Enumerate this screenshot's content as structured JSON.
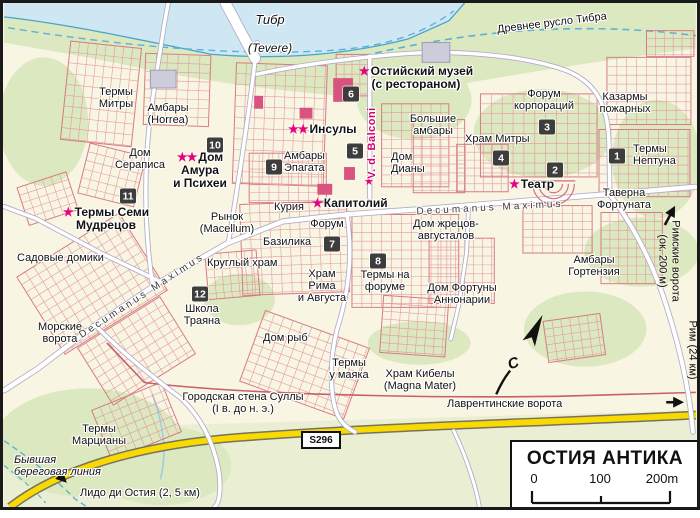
{
  "legend": {
    "title": "ОСТИЯ АНТИКА",
    "scale": {
      "ticks": [
        "0",
        "100",
        "200m"
      ]
    }
  },
  "road_badge": {
    "text": "S296",
    "x": 298,
    "y": 428
  },
  "north": {
    "label": "С",
    "x": 505,
    "y": 352
  },
  "colors": {
    "background": "#f8f5e3",
    "green": "#dce8bf",
    "south_green": "#eaeed2",
    "water": "#cfe7f3",
    "water_line": "#4aa3cb",
    "water_dash": "#58b2d9",
    "ruin": "#d4707e",
    "ruin_light": "#e2929c",
    "building_accent": "#d9537f",
    "building_grey": "#cdccdb",
    "building_grey_line": "#9d9cb4",
    "road_fill": "#ffffff",
    "road_casing": "#b2abc7",
    "yellow_road": "#f8da00",
    "yellow_casing": "#77725f",
    "wall": "#c75f6d",
    "marker_bg": "#3d3d3d",
    "marker_text": "#ffffff",
    "star": "#e6007f",
    "street_label": "#3a3a3a",
    "label": "#121212",
    "frame": "#1a1a1a"
  },
  "water_labels": [
    {
      "id": "tiber",
      "lines": [
        "Тибр"
      ],
      "x": 267,
      "y": 10,
      "align": "center",
      "i": true,
      "fs": 13
    },
    {
      "id": "tevere",
      "lines": [
        "(Tevere)"
      ],
      "x": 267,
      "y": 39,
      "align": "center",
      "i": true,
      "fs": 12
    },
    {
      "id": "old-riverbed",
      "lines": [
        "Древнее русло Тибра"
      ],
      "x": 549,
      "y": 15,
      "align": "center",
      "fs": 11,
      "rot": -7
    }
  ],
  "labels": [
    {
      "id": "termy-mitry",
      "lines": [
        "Термы",
        "Митры"
      ],
      "x": 113,
      "y": 84,
      "align": "center"
    },
    {
      "id": "ambary-horrea",
      "lines": [
        "Амбары",
        "(Horrea)"
      ],
      "x": 165,
      "y": 100,
      "align": "center"
    },
    {
      "id": "dom-serapisa",
      "lines": [
        "Дом",
        "Сераписа"
      ],
      "x": 137,
      "y": 145,
      "align": "center"
    },
    {
      "id": "dom-amura-i-psihei",
      "lines": [
        "Дом",
        "Амура",
        "и Психеи"
      ],
      "x": 197,
      "y": 148,
      "align": "center",
      "b": true,
      "fs": 12,
      "stars": 2
    },
    {
      "id": "termy-semi-mudretsov",
      "lines": [
        "Термы Семи",
        "Мудрецов"
      ],
      "x": 103,
      "y": 203,
      "align": "center",
      "b": true,
      "fs": 12,
      "stars": 1
    },
    {
      "id": "sadovye-domiki",
      "lines": [
        "Садовые домики"
      ],
      "x": 14,
      "y": 250
    },
    {
      "id": "morskie-vorota",
      "lines": [
        "Морские",
        "ворота"
      ],
      "x": 57,
      "y": 319,
      "align": "center"
    },
    {
      "id": "shkola-trayana",
      "lines": [
        "Школа",
        "Траяна"
      ],
      "x": 199,
      "y": 301,
      "align": "center"
    },
    {
      "id": "rynok-macellum",
      "lines": [
        "Рынок",
        "(Macellum)"
      ],
      "x": 224,
      "y": 209,
      "align": "center"
    },
    {
      "id": "kruglyj-hram",
      "lines": [
        "Круглый храм"
      ],
      "x": 204,
      "y": 255
    },
    {
      "id": "kuriya",
      "lines": [
        "Курия"
      ],
      "x": 271,
      "y": 199
    },
    {
      "id": "kapitolij",
      "lines": [
        "Капитолий"
      ],
      "x": 309,
      "y": 194,
      "b": true,
      "fs": 12,
      "stars": 1
    },
    {
      "id": "forum",
      "lines": [
        "Форум"
      ],
      "x": 324,
      "y": 216,
      "align": "center"
    },
    {
      "id": "bazilika",
      "lines": [
        "Базилика"
      ],
      "x": 260,
      "y": 234
    },
    {
      "id": "hram-rima-i-avgusta",
      "lines": [
        "Храм",
        "Рима",
        "и Августа"
      ],
      "x": 319,
      "y": 266,
      "align": "center"
    },
    {
      "id": "termy-na-forume",
      "lines": [
        "Термы на",
        "форуме"
      ],
      "x": 382,
      "y": 267,
      "align": "center"
    },
    {
      "id": "dom-ryb",
      "lines": [
        "Дом рыб"
      ],
      "x": 260,
      "y": 330
    },
    {
      "id": "termy-u-mayaka",
      "lines": [
        "Термы",
        "у маяка"
      ],
      "x": 346,
      "y": 355,
      "align": "center"
    },
    {
      "id": "hram-kibely",
      "lines": [
        "Храм Кибелы",
        "(Magna Mater)"
      ],
      "x": 417,
      "y": 366,
      "align": "center"
    },
    {
      "id": "dom-zhretsov-avgustalov",
      "lines": [
        "Дом жрецов-",
        "августалов"
      ],
      "x": 443,
      "y": 216,
      "align": "center"
    },
    {
      "id": "dom-fortuny-annonarii",
      "lines": [
        "Дом Фортуны",
        "Аннонарии"
      ],
      "x": 459,
      "y": 280,
      "align": "center"
    },
    {
      "id": "ambary-gortenziya",
      "lines": [
        "Амбары",
        "Гортензия"
      ],
      "x": 591,
      "y": 252,
      "align": "center"
    },
    {
      "id": "ambary-epagata",
      "lines": [
        "Амбары",
        "Эпагата"
      ],
      "x": 281,
      "y": 148
    },
    {
      "id": "insuly",
      "lines": [
        "Инсулы"
      ],
      "x": 285,
      "y": 120,
      "b": true,
      "fs": 12,
      "stars": 2
    },
    {
      "id": "ostijskij-muzej",
      "lines": [
        "Остийский музей",
        "(с рестораном)"
      ],
      "x": 413,
      "y": 62,
      "align": "center",
      "b": true,
      "fs": 12,
      "stars": 1
    },
    {
      "id": "bolshie-ambary",
      "lines": [
        "Большие",
        "амбары"
      ],
      "x": 430,
      "y": 111,
      "align": "center"
    },
    {
      "id": "hram-mitry",
      "lines": [
        "Храм Митры"
      ],
      "x": 462,
      "y": 131
    },
    {
      "id": "forum-korporacij",
      "lines": [
        "Форум",
        "корпораций"
      ],
      "x": 541,
      "y": 86,
      "align": "center"
    },
    {
      "id": "kazarmy-pozharnyh",
      "lines": [
        "Казармы",
        "пожарных"
      ],
      "x": 622,
      "y": 89,
      "align": "center"
    },
    {
      "id": "termy-neptuna",
      "lines": [
        "Термы",
        "Нептуна"
      ],
      "x": 630,
      "y": 141
    },
    {
      "id": "teatr",
      "lines": [
        "Театр"
      ],
      "x": 506,
      "y": 175,
      "b": true,
      "fs": 12,
      "stars": 1
    },
    {
      "id": "taverna-fortunata",
      "lines": [
        "Таверна",
        "Фортуната"
      ],
      "x": 621,
      "y": 185,
      "align": "center"
    },
    {
      "id": "dom-diany",
      "lines": [
        "Дом",
        "Дианы"
      ],
      "x": 388,
      "y": 149
    },
    {
      "id": "dom-diany-star",
      "lines": [],
      "x": 361,
      "y": 174,
      "stars": 1
    },
    {
      "id": "gorodskaya-stena-sully",
      "lines": [
        "Городская стена Суллы",
        "(I в. до н. э.)"
      ],
      "x": 240,
      "y": 389,
      "align": "center"
    },
    {
      "id": "termy-marciany",
      "lines": [
        "Термы",
        "Марцианы"
      ],
      "x": 96,
      "y": 421,
      "align": "center"
    },
    {
      "id": "byvshaya-beregovaya-liniya",
      "lines": [
        "Бывшая",
        "береговая линия"
      ],
      "x": 11,
      "y": 452,
      "i": true
    },
    {
      "id": "lido-di-ostiya",
      "lines": [
        "Лидо ди Остия (2, 5 км)"
      ],
      "x": 77,
      "y": 485
    },
    {
      "id": "lavrentinskie-vorota",
      "lines": [
        "Лаврентинские ворота"
      ],
      "x": 444,
      "y": 396
    }
  ],
  "street_labels": [
    {
      "id": "decumanus-maximus-west",
      "text": "Decumanus Maximus",
      "x": 139,
      "y": 293,
      "rot": -33
    },
    {
      "id": "decumanus-maximus-east",
      "text": "Decumanus Maximus",
      "x": 487,
      "y": 205,
      "rot": -3
    },
    {
      "id": "via-dei-balconi",
      "text": "V. d. Balconi",
      "x": 369,
      "y": 140,
      "rot": -90,
      "accent": true
    }
  ],
  "vertical_labels": [
    {
      "id": "rimskie-vorota",
      "lines": [
        "Римские ворота",
        "(ок. 200 м)"
      ],
      "x": 666,
      "y": 258
    },
    {
      "id": "rim-24-km",
      "lines": [
        "Рим (24 км)"
      ],
      "x": 689,
      "y": 347
    }
  ],
  "markers": [
    {
      "n": "1",
      "x": 614,
      "y": 153
    },
    {
      "n": "2",
      "x": 552,
      "y": 167
    },
    {
      "n": "3",
      "x": 544,
      "y": 124
    },
    {
      "n": "4",
      "x": 498,
      "y": 155
    },
    {
      "n": "5",
      "x": 352,
      "y": 148
    },
    {
      "n": "6",
      "x": 348,
      "y": 91
    },
    {
      "n": "7",
      "x": 329,
      "y": 241
    },
    {
      "n": "8",
      "x": 375,
      "y": 258
    },
    {
      "n": "9",
      "x": 271,
      "y": 164
    },
    {
      "n": "10",
      "x": 212,
      "y": 142
    },
    {
      "n": "11",
      "x": 125,
      "y": 193
    },
    {
      "n": "12",
      "x": 197,
      "y": 291
    }
  ]
}
